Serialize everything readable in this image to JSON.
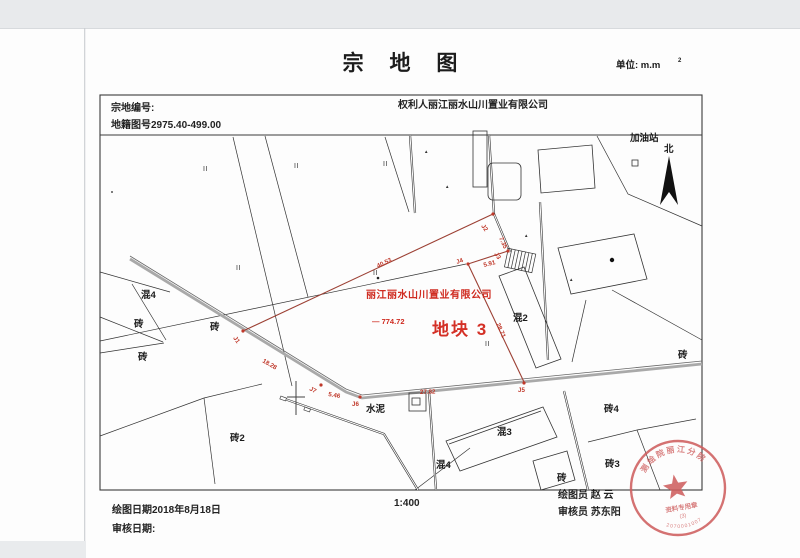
{
  "page": {
    "title": "宗 地 图",
    "unit_label": "单位: m.m",
    "unit_sup": "2"
  },
  "header": {
    "parcel_no_label": "宗地编号:",
    "cadastral_no": "地籍图号2975.40-499.00",
    "owner": "权利人丽江丽水山川置业有限公司"
  },
  "map": {
    "plot_owner": "丽江丽水山川置业有限公司",
    "plot_area": "— 774.72",
    "plot_name": "地块 3",
    "ii_symbol": "II",
    "control_symbol": "▲",
    "land_labels": [
      {
        "t": "混4",
        "x": 141,
        "y": 298
      },
      {
        "t": "砖",
        "x": 134,
        "y": 327
      },
      {
        "t": "砖",
        "x": 210,
        "y": 330
      },
      {
        "t": "砖",
        "x": 138,
        "y": 360
      },
      {
        "t": "砖2",
        "x": 230,
        "y": 441
      },
      {
        "t": "水泥",
        "x": 366,
        "y": 412
      },
      {
        "t": "混2",
        "x": 513,
        "y": 321
      },
      {
        "t": "混3",
        "x": 497,
        "y": 435
      },
      {
        "t": "混4",
        "x": 436,
        "y": 468
      },
      {
        "t": "砖",
        "x": 557,
        "y": 481
      },
      {
        "t": "砖3",
        "x": 605,
        "y": 467
      },
      {
        "t": "砖4",
        "x": 604,
        "y": 412
      },
      {
        "t": "砖",
        "x": 678,
        "y": 358
      },
      {
        "t": "加油站",
        "x": 630,
        "y": 141
      },
      {
        "t": "北",
        "x": 664,
        "y": 152
      }
    ],
    "ii_marks": [
      {
        "x": 203,
        "y": 171
      },
      {
        "x": 294,
        "y": 168
      },
      {
        "x": 383,
        "y": 166
      },
      {
        "x": 236,
        "y": 270
      },
      {
        "x": 373,
        "y": 275
      },
      {
        "x": 485,
        "y": 346
      }
    ],
    "control_marks": [
      {
        "x": 424,
        "y": 153
      },
      {
        "x": 445,
        "y": 188
      },
      {
        "x": 524,
        "y": 237
      },
      {
        "x": 569,
        "y": 281
      }
    ],
    "boundary_points": [
      {
        "name": "J1",
        "x": 243,
        "y": 331
      },
      {
        "name": "J2",
        "x": 493,
        "y": 214
      },
      {
        "name": "J3",
        "x": 508,
        "y": 251
      },
      {
        "name": "J4",
        "x": 468,
        "y": 264
      },
      {
        "name": "J5",
        "x": 524,
        "y": 383
      },
      {
        "name": "J6",
        "x": 360,
        "y": 397
      },
      {
        "name": "J7",
        "x": 321,
        "y": 385
      }
    ],
    "red_labels": [
      {
        "t": "40.53",
        "x": 378,
        "y": 268,
        "r": -26
      },
      {
        "t": "J1",
        "x": 233,
        "y": 338,
        "r": 55
      },
      {
        "t": "18.28",
        "x": 262,
        "y": 362,
        "r": 30
      },
      {
        "t": "J7",
        "x": 309,
        "y": 390,
        "r": 28
      },
      {
        "t": "5.46",
        "x": 328,
        "y": 396,
        "r": 10
      },
      {
        "t": "J6",
        "x": 352,
        "y": 406,
        "r": 0
      },
      {
        "t": "27.82",
        "x": 420,
        "y": 394,
        "r": -2
      },
      {
        "t": "J5",
        "x": 518,
        "y": 392,
        "r": 0
      },
      {
        "t": "28.71",
        "x": 496,
        "y": 324,
        "r": 66
      },
      {
        "t": "J4",
        "x": 457,
        "y": 264,
        "r": -20
      },
      {
        "t": "5.91",
        "x": 484,
        "y": 267,
        "r": -14
      },
      {
        "t": "J3",
        "x": 494,
        "y": 254,
        "r": 55
      },
      {
        "t": "7.35",
        "x": 499,
        "y": 238,
        "r": 66
      },
      {
        "t": "J2",
        "x": 481,
        "y": 226,
        "r": 55
      }
    ]
  },
  "footer": {
    "scale": "1:400",
    "draw_date": "绘图日期2018年8月18日",
    "review_date": "审核日期:",
    "drafter": "绘图员 赵 云",
    "reviewer": "审核员 苏东阳"
  },
  "seal": {
    "arc_text": "测绘院丽江分院",
    "stamp_label": "资料专用章",
    "stamp_no": "(3)",
    "serial": "2070001007"
  }
}
